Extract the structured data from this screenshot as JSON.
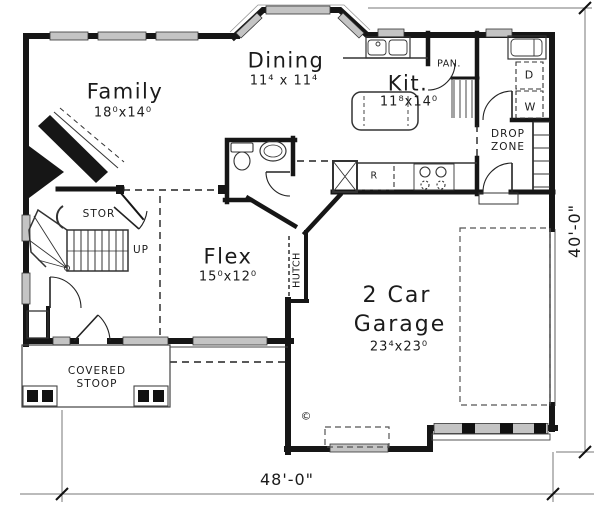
{
  "rooms": {
    "family": {
      "label": "Family",
      "dims": "18⁰x14⁰"
    },
    "dining": {
      "label": "Dining",
      "dims": "11⁴ x 11⁴"
    },
    "kitchen": {
      "label": "Kit.",
      "dims": "11⁸x14⁰"
    },
    "flex": {
      "label": "Flex",
      "dims": "15⁰x12⁰"
    },
    "garage": {
      "label_line1": "2 Car",
      "label_line2": "Garage",
      "dims": "23⁴x23⁰"
    }
  },
  "annotations": {
    "pantry": "PAN.",
    "drop_zone_line1": "DROP",
    "drop_zone_line2": "ZONE",
    "storage": "STOR",
    "up": "UP",
    "hutch": "HUTCH",
    "stoop_line1": "COVERED",
    "stoop_line2": "STOOP",
    "refrigerator": "R",
    "dryer": "D",
    "washer": "W",
    "copyright": "©"
  },
  "dimensions": {
    "overall_width": "48'-0\"",
    "overall_depth": "40'-0\""
  },
  "colors": {
    "wall": "#161616",
    "window_fill": "#c4c4c4",
    "dim_line": "#666666"
  }
}
